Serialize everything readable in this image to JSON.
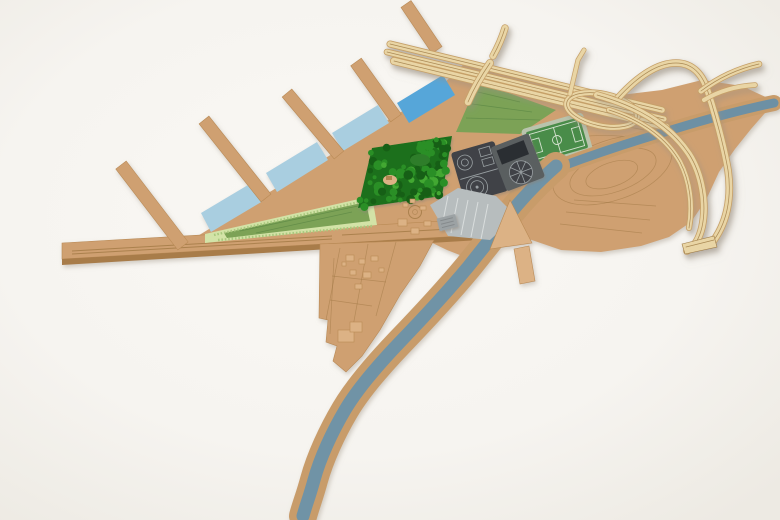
{
  "scene": {
    "label": "Wooden architectural site model photographed on a white background",
    "type": "physical-scale-model-photo"
  },
  "colors": {
    "background": "#f7f5f1",
    "background_edge": "#eeeae3",
    "mdf": "#cfa071",
    "mdf_light": "#dcb285",
    "mdf_dark": "#b98a55",
    "mdf_side": "#a87b48",
    "mdf_etch": "#9b733f",
    "ply": "#e9d5a5",
    "ply_edge": "#c6a067",
    "ply_line": "#9f7b45",
    "water_light": "#a9cee0",
    "water_bright": "#56a6d9",
    "canal": "#6d90a4",
    "river": "#6f93a6",
    "river_bank": "#c89c6a",
    "green_field": "#7ba257",
    "green_field_dark": "#5f8a45",
    "green_band": "#d3e3a7",
    "green_band_dot": "#a9c87e",
    "pitch": "#4a8c49",
    "pitch_mat": "#b9c4ad",
    "pitch_line": "#d4e2cf",
    "trees_base": "#1d6f1a",
    "trees_mid": "#2c8f26",
    "trees_light": "#43a832",
    "trees_dark": "#175e13",
    "panel_dark": "#3f4347",
    "panel_mid": "#5a5e61",
    "panel_black": "#2b2e31",
    "panel_line": "#9aa0a3",
    "gray_parking": "#b7bdbe",
    "gray_stripe": "#d9dddd",
    "gray_building": "#9ca2a4",
    "gray_building_dark": "#7f8587",
    "shadow": "#a89f90"
  },
  "parts": [
    {
      "id": "quay-embankment"
    },
    {
      "id": "finger-piers",
      "count": 5
    },
    {
      "id": "dock-water-basins",
      "count": 4
    },
    {
      "id": "terraced-park-triangle"
    },
    {
      "id": "tree-grove"
    },
    {
      "id": "sports-field"
    },
    {
      "id": "soccer-pitch"
    },
    {
      "id": "gasworks-panels",
      "count": 2
    },
    {
      "id": "parking-lot"
    },
    {
      "id": "old-town-peninsula"
    },
    {
      "id": "river"
    },
    {
      "id": "canal"
    },
    {
      "id": "elevated-highway"
    },
    {
      "id": "slip-loop-ramp"
    },
    {
      "id": "interchange-ramps",
      "count": 5
    }
  ]
}
